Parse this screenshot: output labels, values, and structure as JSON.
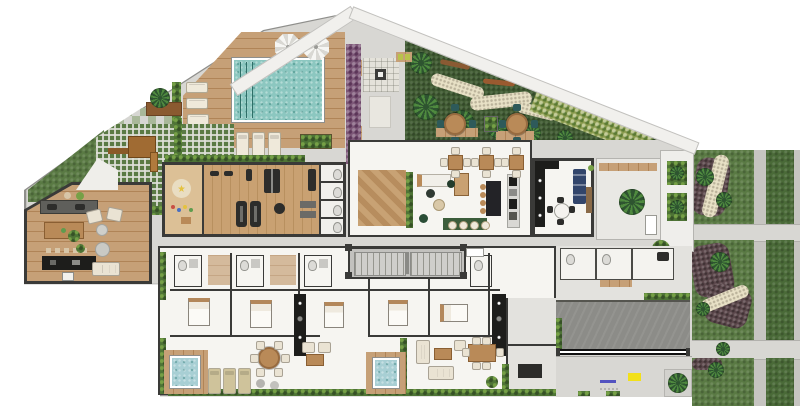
{
  "app": {
    "type": "architectural-floorplan",
    "description": "Top-down rendered site plan: residential ground floor with leisure deck, pool, gym, lobby, apartments, gardens, driveway and street"
  },
  "palette": {
    "concrete": "#d8d7d3",
    "wall": "#3a3a38",
    "wall_mid": "#8f8f8c",
    "deck_wood": "#c6a077",
    "deck_wood_dark": "#b08457",
    "room_wood": "#c9a172",
    "room_wood_dark": "#b8905f",
    "wood_light": "#dcc096",
    "pool_water": "#8cc7c0",
    "pool_line": "#2f6f68",
    "spa_water": "#a8cfd4",
    "grass": "#5a7a44",
    "grass_dark": "#415c33",
    "hedge": "#4e7436",
    "hedge_light": "#76a046",
    "shrub_yellow": "#8a9b4e",
    "mulch": "#5b474b",
    "gravel": "#e8e1c6",
    "purple_hedge": "#7d5878",
    "road": "#c6c5c1",
    "road_light": "#d8d7d3",
    "verge": "#4a6a38",
    "driveway": "#8c8c88",
    "black": "#1d1d1b",
    "cream": "#efe9da",
    "sofa_cream": "#eae3d3",
    "blue_sofa": "#32456b",
    "teal_chair": "#2e5a5a",
    "green_rug": "#3c5d3b",
    "pouf_green": "#2a4d36",
    "table_wood": "#b98a58",
    "bed_wood": "#b3875a",
    "palm_dark": "#2e5430",
    "palm_light": "#4f8a3f",
    "paver_green": "#a9b89a",
    "paver_gray": "#d6d6d2",
    "kids_red": "#c94f43",
    "kids_blue": "#4a6fc0",
    "kids_yellow": "#e4c23f",
    "kids_green": "#5f9c4e",
    "yellow_mark": "#f2e019",
    "blue_mark": "#5353c0",
    "room_floor": "#f6f5f1",
    "gray_floor": "#e3e2de",
    "stone": "#e4e2da",
    "dark_equip": "#2d2d2b"
  },
  "elements": [
    "swimming-pool",
    "lap-lane",
    "pool-deck",
    "umbrella",
    "sun-lounger",
    "zen-garden",
    "palm-tree",
    "stone-path",
    "fire-pit",
    "bench",
    "purple-hedge",
    "gym",
    "treadmill",
    "exercise-ball",
    "kids-playroom",
    "lockers",
    "lobby-lounge",
    "herringbone-rug",
    "reception-desk",
    "bar-counter",
    "bar-stool",
    "dining-table",
    "party-room",
    "kitchen",
    "blue-sofa",
    "courtyard-tree",
    "playground",
    "play-structure",
    "coworking-room",
    "work-table",
    "patio",
    "outdoor-sofa",
    "apartment",
    "bedroom",
    "bed",
    "bathroom",
    "stair-core",
    "elevator-tag",
    "plunge-pool",
    "terrace",
    "hedge",
    "driveway",
    "entrance-gate",
    "sidewalk",
    "tactile-marking",
    "street",
    "garden-bed",
    "mulch-path",
    "gravel-path",
    "crosswalk",
    "verge"
  ]
}
